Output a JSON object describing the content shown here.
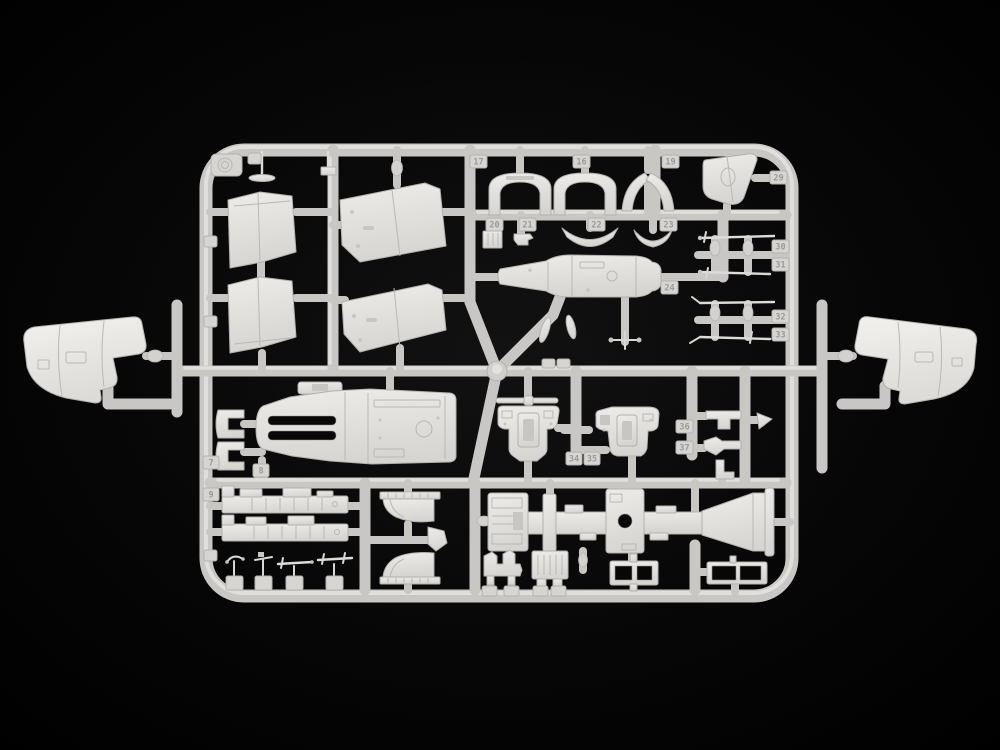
{
  "subject": "light grey injection-molded model kit parts sprue photographed on a black background",
  "colors": {
    "background": "#000000",
    "plastic_base": "#c8c7c3",
    "plastic_highlight": "#e4e3df",
    "plastic_shadow": "#b2b1ad",
    "part_fill_light": "#edece8",
    "part_fill_dark": "#d6d5d1",
    "tag_fill": "#d6d5d1",
    "tag_text": "#9b9a96",
    "hole": "#070707"
  },
  "part_numbers": {
    "n7": "7",
    "n8": "8",
    "n9": "9",
    "n16": "16",
    "n17": "17",
    "n19": "19",
    "n20": "20",
    "n21": "21",
    "n22": "22",
    "n23": "23",
    "n24": "24",
    "n29": "29",
    "n30": "30",
    "n31": "31",
    "n32": "32",
    "n33": "33",
    "n34": "34",
    "n35": "35",
    "n36": "36",
    "n37": "37"
  }
}
